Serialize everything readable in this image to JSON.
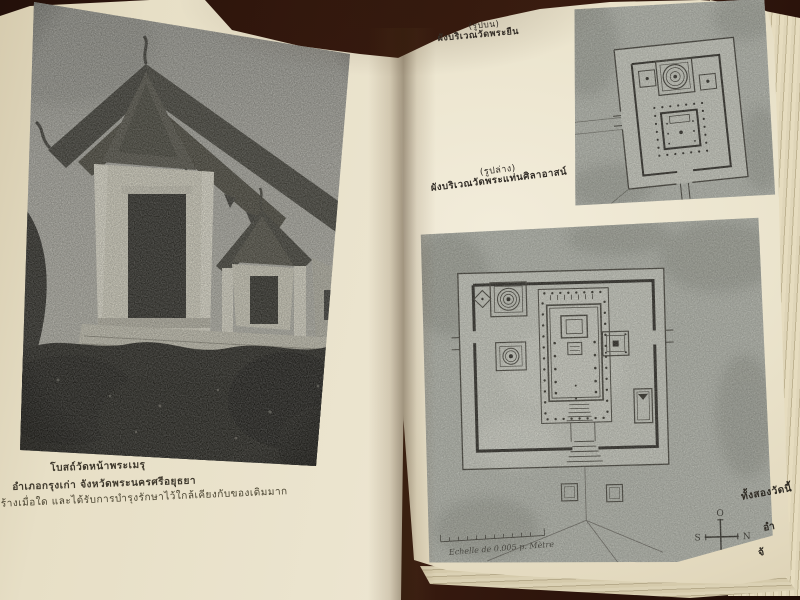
{
  "palette": {
    "background": "#2a130b",
    "page": "#e9e2cb",
    "ink": "#3b352b",
    "photo_gray": "#a8a79d",
    "plan_gray": "#b5b8ad"
  },
  "left_page": {
    "caption": {
      "line1": "โบสถ์วัดหน้าพระเมรุ",
      "line2": "อำเภอกรุงเก่า จังหวัดพระนครศรีอยุธยา",
      "line3": "สร้างเมื่อใด และได้รับการบำรุงรักษาไว้ใกล้เคียงกับของเดิมมาก"
    }
  },
  "right_page": {
    "upper_caption": {
      "label": "(รูปบน)",
      "title": "ผังบริเวณวัดพระยืน"
    },
    "lower_caption": {
      "label": "(รูปล่าง)",
      "title": "ผังบริเวณวัดพระแท่นศิลาอาสน์"
    },
    "corner_note": {
      "line1": "ทั้งสองวัดนี้",
      "line2": "อำ",
      "line3": "จั"
    },
    "plan": {
      "scale_label": "Echelle de 0.005 p. Mètre",
      "compass": {
        "top": "O",
        "left": "S",
        "right": "N",
        "bottom": "E"
      }
    }
  }
}
